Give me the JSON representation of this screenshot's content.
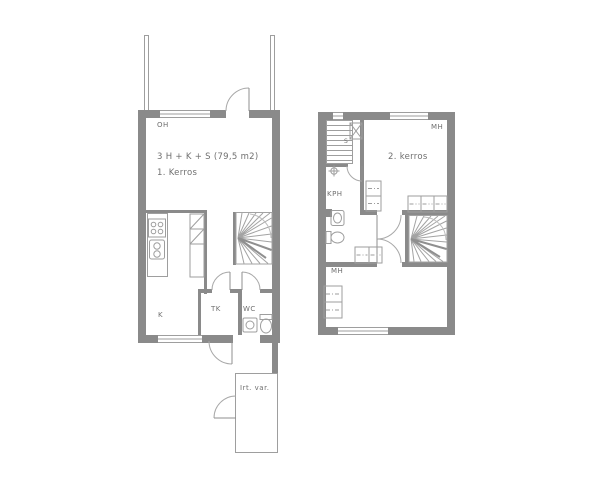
{
  "colors": {
    "wall": "#8a8a8a",
    "line": "#9e9e9e",
    "text": "#6f6f6f",
    "background": "#ffffff"
  },
  "floor1": {
    "title": "3 H + K + S (79,5 m2)",
    "floor_label": "1. Kerros",
    "room_labels": {
      "living_room": "OH",
      "kitchen": "K",
      "vestibule": "TK",
      "toilet": "WC"
    },
    "storage_label": "Irt. var."
  },
  "floor2": {
    "floor_label": "2. kerros",
    "room_labels": {
      "bedroom_top": "MH",
      "bedroom_bottom": "MH",
      "bathroom": "KPH",
      "sauna": "S"
    }
  }
}
